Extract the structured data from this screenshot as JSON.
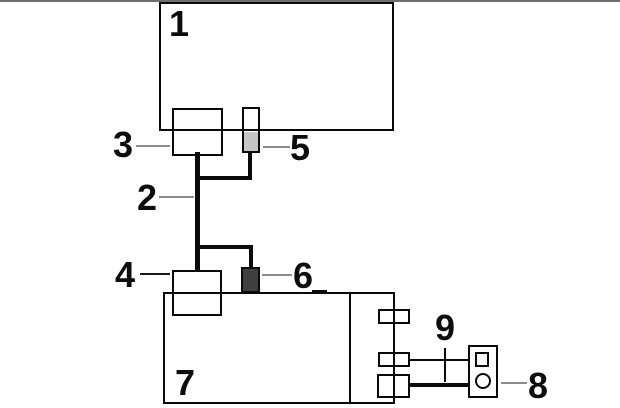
{
  "diagram": {
    "kind": "wiring-connection-diagram",
    "labels": {
      "l1": "1",
      "l2": "2",
      "l3": "3",
      "l4": "4",
      "l5": "5",
      "l6": "6",
      "l7": "7",
      "l8": "8",
      "l9": "9"
    },
    "colors": {
      "background": "#ffffff",
      "outline": "#0a0a0a",
      "top_rule": "#6e6e6e",
      "plug5_fill": "#c4c4c4",
      "plug6_fill": "#404040",
      "callout_pointer_gray": "#8c8c8c",
      "callout_pointer_dark": "#1a1a1a"
    }
  }
}
